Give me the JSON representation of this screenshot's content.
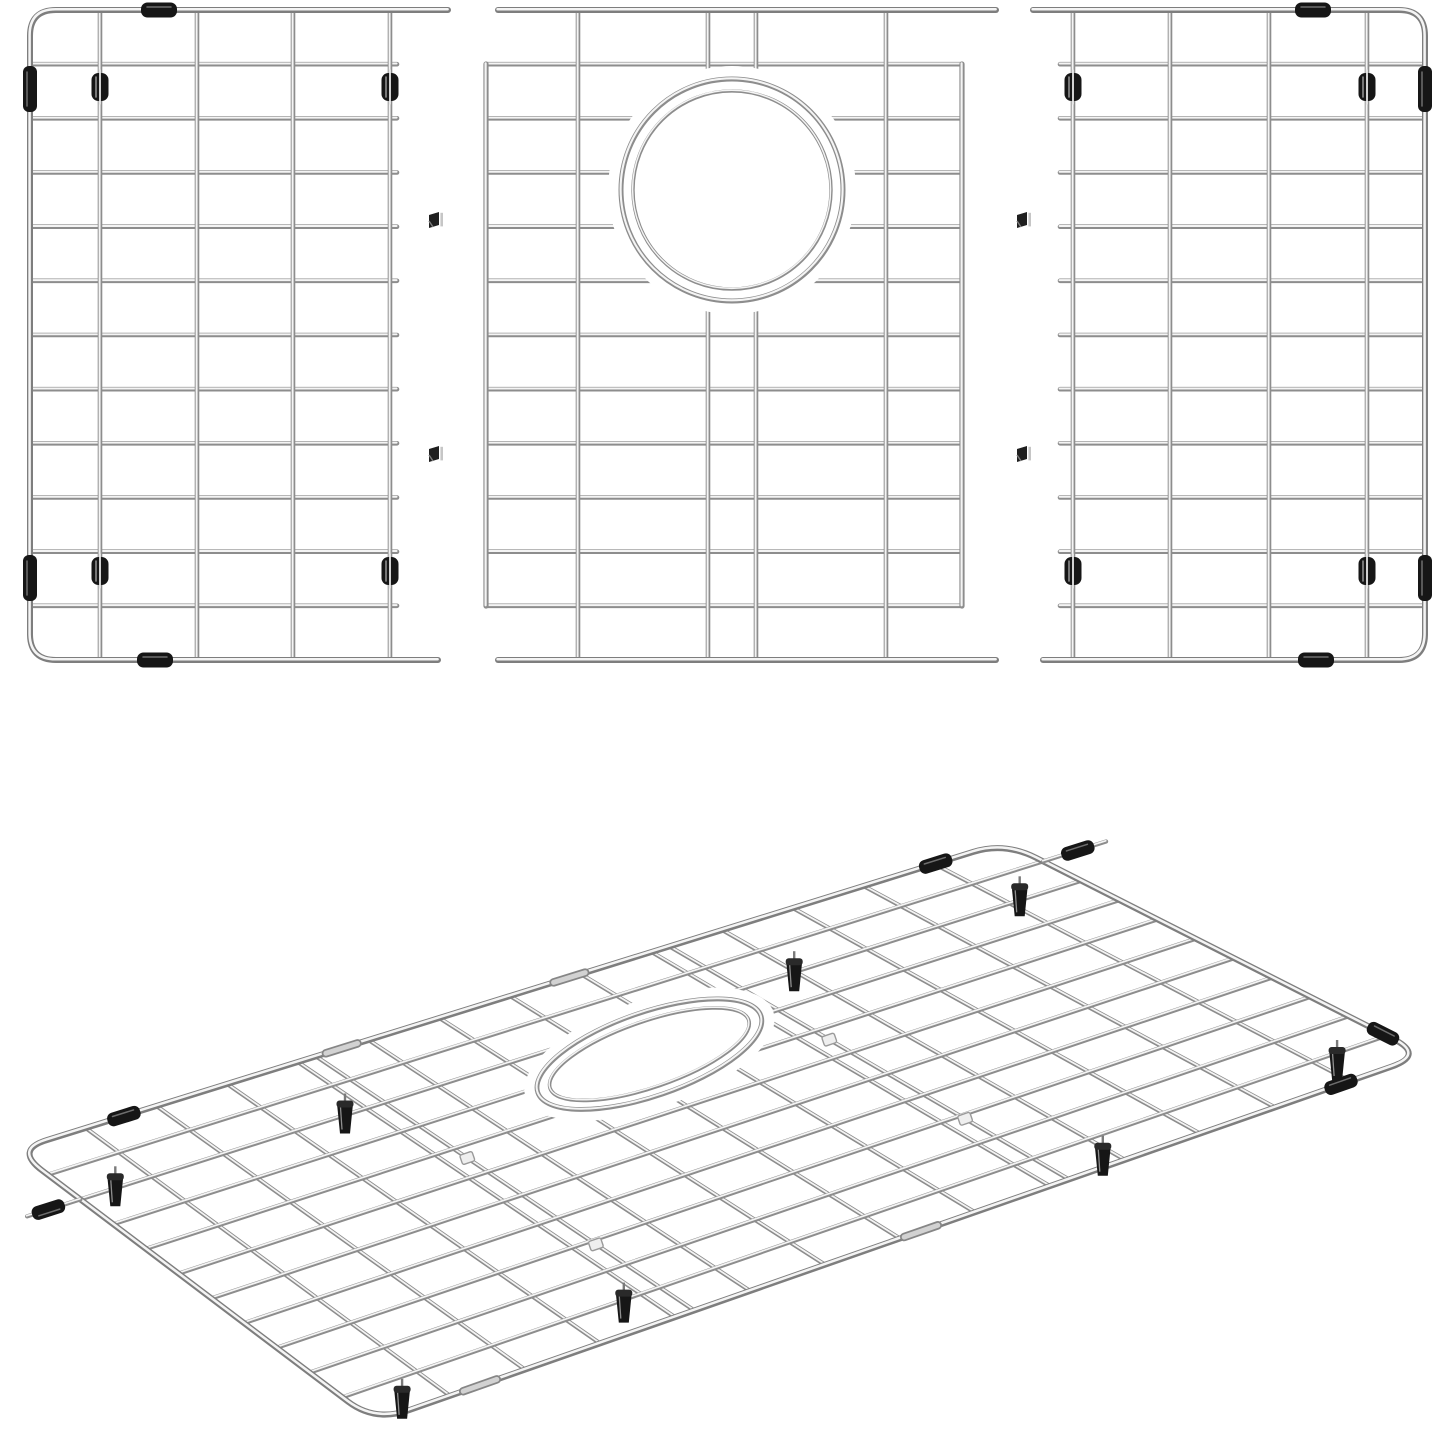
{
  "meta": {
    "description": "Product illustration of a three-piece stainless steel kitchen sink bottom grid: three flat wire panels shown disassembled on top (left panel, center panel with round drain opening, right panel) joined by small clips, and the fully assembled wire rack with black rubber feet and bumpers shown in perspective below.",
    "background_color": "#ffffff"
  },
  "colors": {
    "background": "#ffffff",
    "wire_dark": "#8d8d8d",
    "wire_highlight": "#f4f4f4",
    "frame_dark": "#7e7e7e",
    "rubber_black": "#161616",
    "rubber_highlight": "#8f8f8f",
    "sleeve_light": "#d2d2d2",
    "sleeve_dark": "#868686",
    "joint_clip_fill": "#efefef",
    "joint_clip_stroke": "#9a9a9a"
  },
  "flat_panels": {
    "left": {
      "side": "left",
      "frame_x": 30,
      "corner_radius": 26,
      "rail_y": [
        10,
        660
      ],
      "rail_x_outer": 448,
      "verticals": [
        100,
        197,
        293,
        390
      ],
      "horizontal_count": 11,
      "horizontal_span": [
        30,
        397
      ],
      "feet": [
        [
          100,
          87
        ],
        [
          390,
          87
        ],
        [
          100,
          571
        ],
        [
          390,
          571
        ]
      ],
      "edge_bumpers": [
        [
          30,
          89
        ],
        [
          30,
          578
        ]
      ],
      "rail_clips": [
        [
          159,
          10
        ],
        [
          155,
          660
        ]
      ]
    },
    "center": {
      "rail_y": [
        10,
        660
      ],
      "rail_span": [
        498,
        996
      ],
      "frame_verticals": [
        486,
        962
      ],
      "frame_vertical_span": [
        64,
        606
      ],
      "inner_verticals": [
        578,
        708,
        756,
        886
      ],
      "horizontal_count": 11,
      "horizontal_span": [
        486,
        962
      ],
      "hole": {
        "cx": 732,
        "cy": 190,
        "outer_r": 111,
        "inner_r": 99,
        "mask_r": 124
      }
    },
    "right": {
      "side": "right",
      "frame_x": 1425,
      "corner_radius": 26,
      "rail_y": [
        10,
        660
      ],
      "rail_x_outer": 1033,
      "verticals": [
        1073,
        1170,
        1269,
        1367
      ],
      "horizontal_count": 11,
      "horizontal_span": [
        1060,
        1425
      ],
      "feet": [
        [
          1073,
          87
        ],
        [
          1367,
          87
        ],
        [
          1073,
          571
        ],
        [
          1367,
          571
        ]
      ],
      "edge_bumpers": [
        [
          1425,
          89
        ],
        [
          1425,
          578
        ]
      ],
      "rail_clips": [
        [
          1313,
          10
        ],
        [
          1316,
          660
        ]
      ]
    }
  },
  "connectors": {
    "positions": [
      [
        429,
        212
      ],
      [
        429,
        446
      ],
      [
        1017,
        212
      ],
      [
        1017,
        446
      ]
    ]
  },
  "assembled_view": {
    "quad": {
      "w": [
        15,
        1150
      ],
      "n": [
        1005,
        842
      ],
      "e": [
        1425,
        1055
      ],
      "s": [
        375,
        1422
      ]
    },
    "corner_u": 0.032,
    "corner_v": 0.075,
    "cross_u": [
      0.0714,
      0.1429,
      0.2143,
      0.2857,
      0.304,
      0.3571,
      0.4286,
      0.5,
      0.5714,
      0.6429,
      0.661,
      0.7143,
      0.7857,
      0.8571,
      0.9286
    ],
    "long_v": [
      0.0909,
      0.1818,
      0.2727,
      0.3636,
      0.4545,
      0.5455,
      0.6364,
      0.7273,
      0.8182,
      0.9091
    ],
    "hole": {
      "u": 0.53,
      "v": 0.28,
      "rx": 118,
      "ry": 42,
      "inner_rx": 105,
      "inner_ry": 33,
      "rot": -19,
      "mask_rx": 131,
      "mask_ry": 54
    },
    "feet_uv": [
      [
        0.05,
        0.14
      ],
      [
        0.28,
        0.14
      ],
      [
        0.73,
        0.14
      ],
      [
        0.96,
        0.13
      ],
      [
        0.05,
        0.93
      ],
      [
        0.28,
        0.88
      ],
      [
        0.72,
        0.93
      ],
      [
        0.96,
        0.89
      ]
    ],
    "bumpers": [
      {
        "edge": "far",
        "t": 0.11
      },
      {
        "edge": "far",
        "t": 0.93
      },
      {
        "edge": "right",
        "t": 0.9
      },
      {
        "edge": "near",
        "t": 0.92
      }
    ],
    "rail_tips": [
      {
        "v": 0.0909,
        "side": "right",
        "len": 66,
        "bumper_at": 0.55
      },
      {
        "v": 0.1818,
        "side": "left",
        "len": 56,
        "bumper_at": 0.6
      }
    ],
    "sleeves": [
      {
        "edge": "far",
        "t": 0.33
      },
      {
        "edge": "far",
        "t": 0.56
      },
      {
        "edge": "near",
        "t": 0.1
      },
      {
        "edge": "near",
        "t": 0.52
      }
    ],
    "seam_clips": [
      [
        0.304,
        0.4
      ],
      [
        0.304,
        0.74
      ],
      [
        0.661,
        0.4
      ],
      [
        0.661,
        0.74
      ]
    ]
  }
}
